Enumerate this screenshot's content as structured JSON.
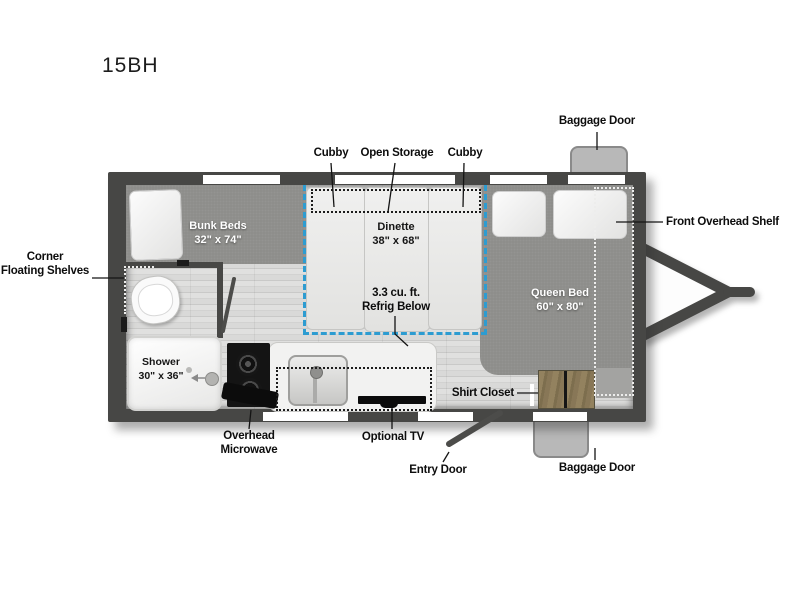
{
  "model": "15BH",
  "rooms": {
    "bunk_beds": {
      "name": "Bunk Beds",
      "size": "32\" x 74\""
    },
    "dinette": {
      "name": "Dinette",
      "size": "38\" x 68\""
    },
    "queen_bed": {
      "name": "Queen Bed",
      "size": "60\" x 80\""
    },
    "shower": {
      "name": "Shower",
      "size": "30\" x 36\""
    }
  },
  "callouts": {
    "cubby_left": "Cubby",
    "open_storage": "Open Storage",
    "cubby_right": "Cubby",
    "baggage_door_front": "Baggage Door",
    "front_overhead_shelf": "Front Overhead Shelf",
    "corner_floating_shelves": {
      "line1": "Corner",
      "line2": "Floating Shelves"
    },
    "refrigerator": {
      "line1": "3.3 cu. ft.",
      "line2": "Refrig Below"
    },
    "shirt_closet": "Shirt Closet",
    "overhead_microwave": {
      "line1": "Overhead",
      "line2": "Microwave"
    },
    "optional_tv": "Optional TV",
    "entry_door": "Entry Door",
    "baggage_door_rear": "Baggage Door"
  },
  "colors": {
    "wall": "#474745",
    "floor_plank": "#d6d6d5",
    "carpet": "#8d8d8a",
    "furniture_white": "#efefee",
    "dinette_dash_accent": "#2d9cd1",
    "closet_wood": "#8a7a5a",
    "appliance_black": "#121212",
    "label_text": "#0d0d0d"
  }
}
